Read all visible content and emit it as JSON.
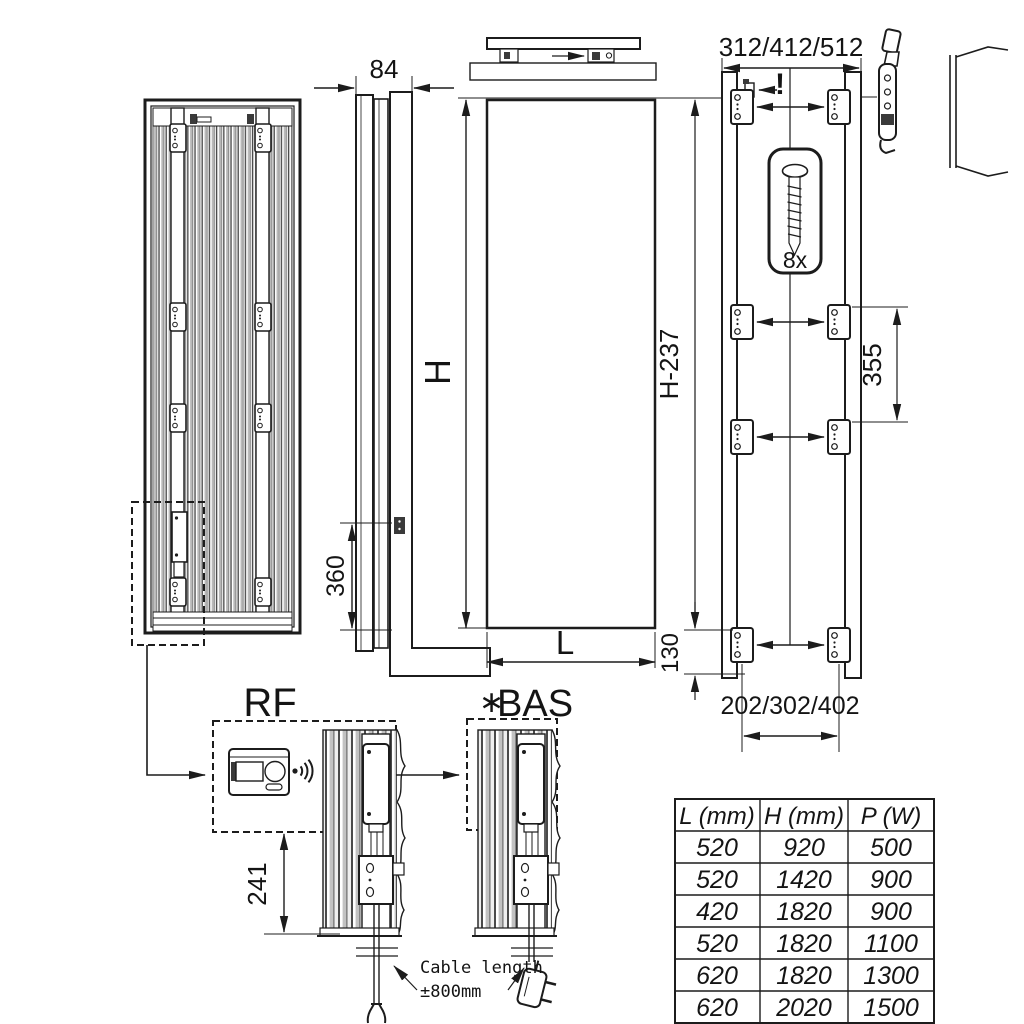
{
  "colors": {
    "line": "#1c1c1c",
    "gray_fill": "#b8b8b8",
    "stripe_dark": "#4a4a4a"
  },
  "dims": {
    "depth_mm": "84",
    "height_label": "H",
    "width_label": "L",
    "side_bottom_mm": "360",
    "wall_bracket_width_mm": "312/412/512",
    "warning_mark": "!",
    "screw_count": "8x",
    "bracket_height_mm": "H-237",
    "bracket_mid_spacing_mm": "355",
    "bracket_bottom_offset_mm": "130",
    "bracket_hole_spacing_mm": "202/302/402",
    "control_height_mm": "241"
  },
  "variants": {
    "rf": "RF",
    "bas_star": "∗",
    "bas": "BAS"
  },
  "cable_note": {
    "line1": "Cable length",
    "line2": "±800mm"
  },
  "table": {
    "headers": [
      "L (mm)",
      "H (mm)",
      "P (W)"
    ],
    "rows": [
      [
        "520",
        "920",
        "500"
      ],
      [
        "520",
        "1420",
        "900"
      ],
      [
        "420",
        "1820",
        "900"
      ],
      [
        "520",
        "1820",
        "1100"
      ],
      [
        "620",
        "1820",
        "1300"
      ],
      [
        "620",
        "2020",
        "1500"
      ]
    ]
  }
}
